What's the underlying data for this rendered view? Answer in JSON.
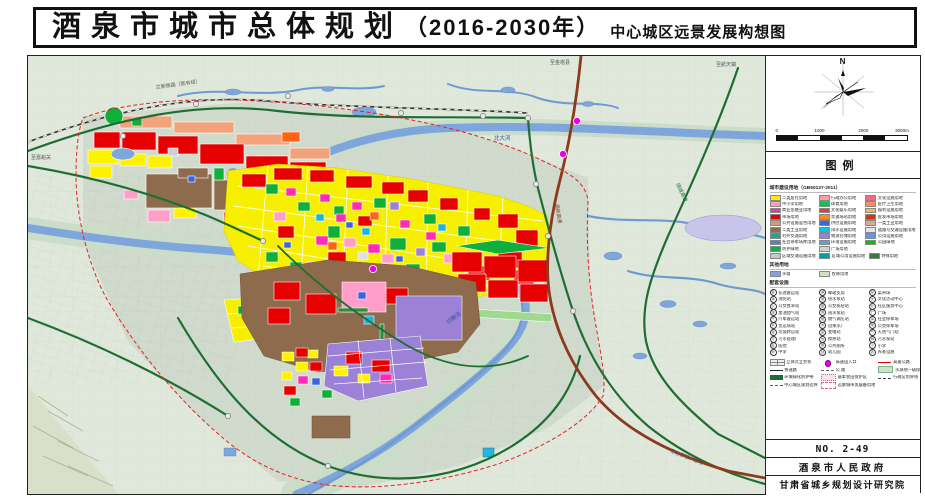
{
  "title": {
    "main": "酒泉市城市总体规划",
    "year": "（2016-2030年）",
    "subtitle": "中心城区远景发展构想图"
  },
  "panel": {
    "north_label": "N",
    "scale_ticks": [
      "0",
      "1000",
      "2000",
      "3000m"
    ],
    "legend_title": "图例",
    "landuse_header": "城市建设用地（GB50137-2011）",
    "landuse": [
      {
        "label": "二类居住用地",
        "color": "#FFF200"
      },
      {
        "label": "中小学用地",
        "color": "#FFA0B4"
      },
      {
        "label": "商业金融业用地",
        "color": "#FF2BB4"
      },
      {
        "label": "市场用地",
        "color": "#E60000"
      },
      {
        "label": "公共设施混合用地",
        "color": "#C8A078"
      },
      {
        "label": "二类工业用地",
        "color": "#8F6B4E"
      },
      {
        "label": "对外交通用地",
        "color": "#2E9E96"
      },
      {
        "label": "社会停车场库用地",
        "color": "#5082C8"
      },
      {
        "label": "防护绿地",
        "color": "#00B450"
      },
      {
        "label": "行政办公用地",
        "color": "#FF9E9E"
      },
      {
        "label": "体育用地",
        "color": "#00C850"
      },
      {
        "label": "文化娱乐用地",
        "color": "#E83C3C"
      },
      {
        "label": "交通场站用地",
        "color": "#FF8C28"
      },
      {
        "label": "供应设施用地",
        "color": "#3C64DC"
      },
      {
        "label": "排水设施用地",
        "color": "#00C8DC"
      },
      {
        "label": "物流仓储用地",
        "color": "#9B82D7"
      },
      {
        "label": "环境设施用地",
        "color": "#5AA0DC"
      },
      {
        "label": "广场用地",
        "color": "#D2D2D2"
      },
      {
        "label": "文化设施用地",
        "color": "#FF6478"
      },
      {
        "label": "医疗卫生用地",
        "color": "#FF8C64"
      },
      {
        "label": "福利设施用地",
        "color": "#FFB450"
      },
      {
        "label": "批发市场用地",
        "color": "#C83C14"
      },
      {
        "label": "一类工业用地",
        "color": "#D7A8A0"
      },
      {
        "label": "道路与交通设施用地",
        "color": "#E6E6E6"
      },
      {
        "label": "公用设施用地",
        "color": "#6496E6"
      },
      {
        "label": "公园绿地",
        "color": "#00C800"
      }
    ],
    "regional": [
      {
        "label": "区域交通设施用地",
        "color": "#C8C8C8"
      },
      {
        "label": "区域公用设施用地",
        "color": "#00A0A0"
      },
      {
        "label": "特殊用地",
        "color": "#3C7846"
      }
    ],
    "other_header": "其他用地",
    "other": [
      {
        "label": "水域",
        "color": "#7FA6DC"
      },
      {
        "label": "农林用地",
        "color": "#CFE3C4"
      }
    ],
    "facilities_header": "配套设施",
    "facilities": [
      {
        "sym": "客",
        "label": "长途客运站"
      },
      {
        "sym": "消",
        "label": "消防站"
      },
      {
        "sym": "公",
        "label": "公交首末站"
      },
      {
        "sym": "油",
        "label": "加油加气站"
      },
      {
        "sym": "汽",
        "label": "汽车客运站"
      },
      {
        "sym": "货",
        "label": "货运场站"
      },
      {
        "sym": "垃",
        "label": "垃圾转运站"
      },
      {
        "sym": "污",
        "label": "污水处理厂"
      },
      {
        "sym": "医",
        "label": "医院"
      },
      {
        "sym": "中",
        "label": "中学"
      },
      {
        "sym": "邮",
        "label": "邮政支局"
      },
      {
        "sym": "泵",
        "label": "给水泵站"
      },
      {
        "sym": "枢",
        "label": "公交枢纽站"
      },
      {
        "sym": "雨",
        "label": "雨水泵站"
      },
      {
        "sym": "燃",
        "label": "燃气调压站"
      },
      {
        "sym": "水",
        "label": "自来水厂"
      },
      {
        "sym": "变",
        "label": "变电站"
      },
      {
        "sym": "热",
        "label": "换热站"
      },
      {
        "sym": "厕",
        "label": "公共厕所"
      },
      {
        "sym": "幼",
        "label": "幼儿园"
      },
      {
        "sym": "菜",
        "label": "菜市场"
      },
      {
        "sym": "文",
        "label": "文化活动中心"
      },
      {
        "sym": "社",
        "label": "社区服务中心"
      },
      {
        "sym": "广",
        "label": "广场"
      },
      {
        "sym": "停",
        "label": "社会停车场"
      },
      {
        "sym": "场",
        "label": "公交停车场"
      },
      {
        "sym": "气",
        "label": "天然气门站"
      },
      {
        "sym": "排",
        "label": "污水泵站"
      },
      {
        "sym": "小",
        "label": "小学"
      },
      {
        "sym": "养",
        "label": "养老设施"
      }
    ],
    "lines": [
      {
        "label": "立体式立交桥",
        "kind": "interchange"
      },
      {
        "label": "快速路",
        "kind": "black-line"
      },
      {
        "label": "环城绿化防护带",
        "kind": "dark-green-band"
      },
      {
        "label": "中心城区规划边界",
        "kind": "red-dash"
      },
      {
        "label": "高速出入口",
        "kind": "magenta-dot"
      },
      {
        "label": "公  路",
        "kind": "gray-dash"
      },
      {
        "label": "基本农田保护区",
        "kind": "pink-dot-band"
      },
      {
        "label": "远景城市发展备用地",
        "kind": "pink-dash-box"
      },
      {
        "label": "高速公路",
        "kind": "red-line"
      },
      {
        "label": "水源地一级保护区",
        "kind": "green-band"
      },
      {
        "label": "行政区划界线",
        "kind": "dash-dot"
      }
    ],
    "sheet_no": "NO. 2-49",
    "gov": "酒泉市人民政府",
    "institute": "甘肃省城乡规划设计研究院"
  },
  "map": {
    "labels": [
      {
        "text": "兰新铁路（既有线）",
        "x": 128,
        "y": 33,
        "size": 5,
        "color": "#555",
        "rotate": -8
      },
      {
        "text": "北大河",
        "x": 466,
        "y": 84,
        "size": 5.5,
        "color": "#2850A0",
        "rotate": 0
      },
      {
        "text": "讨赖河",
        "x": 420,
        "y": 268,
        "size": 5.5,
        "color": "#2850A0",
        "rotate": -35
      },
      {
        "text": "至嘉峪关",
        "x": 3,
        "y": 103,
        "size": 5,
        "color": "#555",
        "rotate": 0
      },
      {
        "text": "至金塔县",
        "x": 522,
        "y": 8,
        "size": 5,
        "color": "#555",
        "rotate": 0
      },
      {
        "text": "至航天镇",
        "x": 688,
        "y": 10,
        "size": 5,
        "color": "#555",
        "rotate": 0
      },
      {
        "text": "酒航高速",
        "x": 527,
        "y": 148,
        "size": 5,
        "color": "#7A3C28",
        "rotate": 80
      },
      {
        "text": "绕城高速",
        "x": 648,
        "y": 128,
        "size": 5,
        "color": "#1E6E32",
        "rotate": 65
      },
      {
        "text": "至总寨镇、上坝",
        "x": 642,
        "y": 396,
        "size": 5,
        "color": "#555",
        "rotate": 22
      }
    ]
  }
}
